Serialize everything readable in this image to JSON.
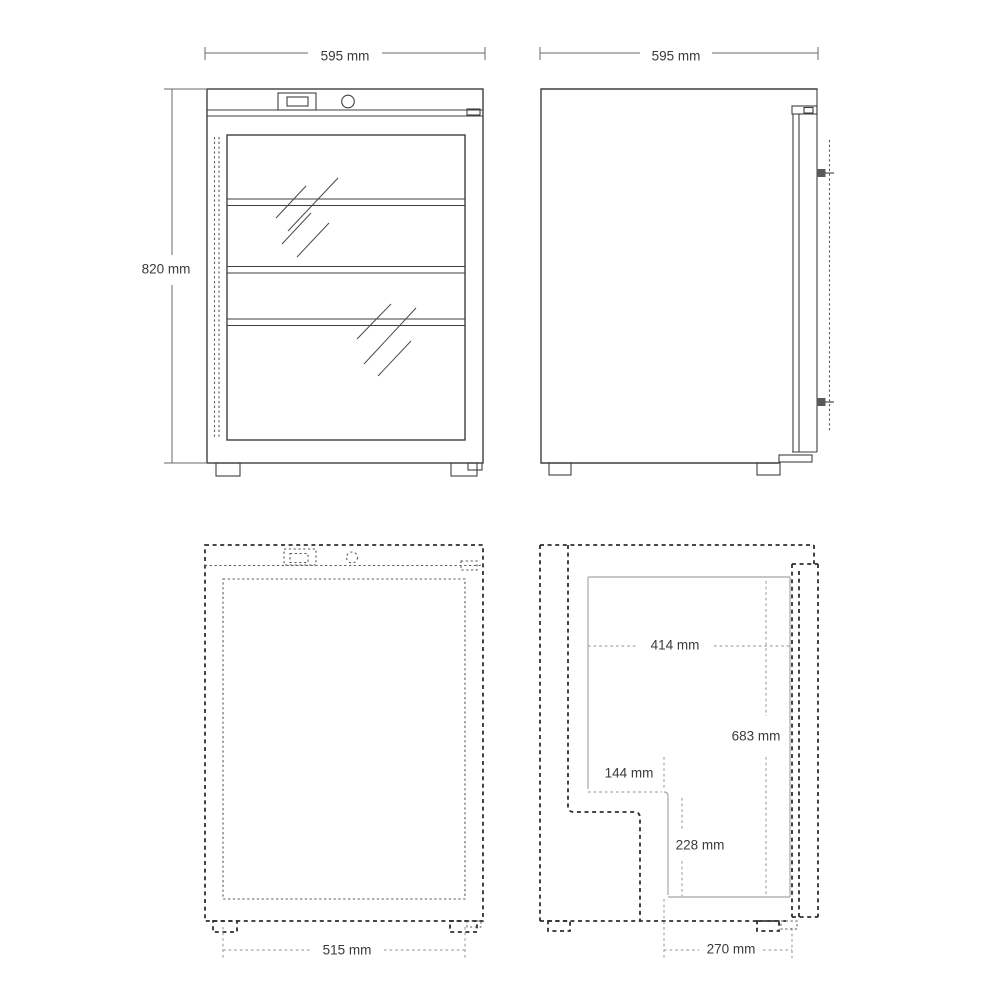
{
  "colors": {
    "line": "#3f3f3f",
    "ghost": "#2f2f2f",
    "fine": "#5a5a5a",
    "light": "#b4b4b4",
    "dim": "#a3a3a3",
    "text": "#3a3a3a",
    "background": "#ffffff"
  },
  "drawing": {
    "front_view": {
      "width_label": "595 mm",
      "height_label": "820 mm"
    },
    "side_view": {
      "depth_label": "595 mm"
    },
    "plan_front_view": {
      "inner_width_label": "515 mm"
    },
    "plan_side_view": {
      "interior_depth_label": "414 mm",
      "interior_height_label": "683 mm",
      "recess_depth_label": "144 mm",
      "recess_height_label": "228 mm",
      "front_depth_label": "270 mm"
    }
  }
}
